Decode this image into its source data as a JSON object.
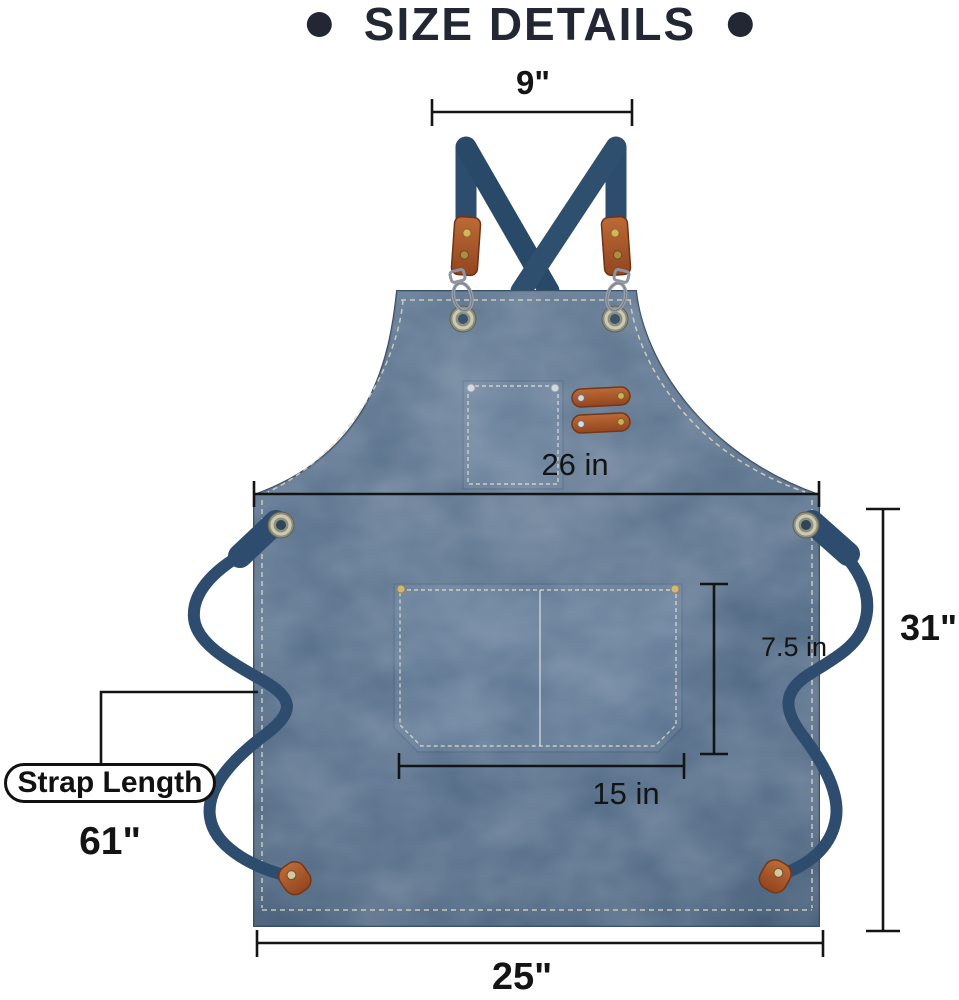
{
  "title": {
    "text": "SIZE DETAILS",
    "bullet_icon": "•"
  },
  "measurements": {
    "strap_top_width": "9\"",
    "chest_width": "26 in",
    "body_height": "31\"",
    "pocket_height": "7.5 in",
    "pocket_width": "15 in",
    "bottom_width": "25\"",
    "strap_length_label": "Strap Length",
    "strap_length_value": "61\""
  },
  "colors": {
    "title_navy": "#232734",
    "apron_canvas_blue": "#4a6480",
    "strap_navy": "#2e4d6e",
    "leather_brown": "#a8582e",
    "stitch_cream": "#ddd8c2",
    "dimension_line": "#141414"
  }
}
